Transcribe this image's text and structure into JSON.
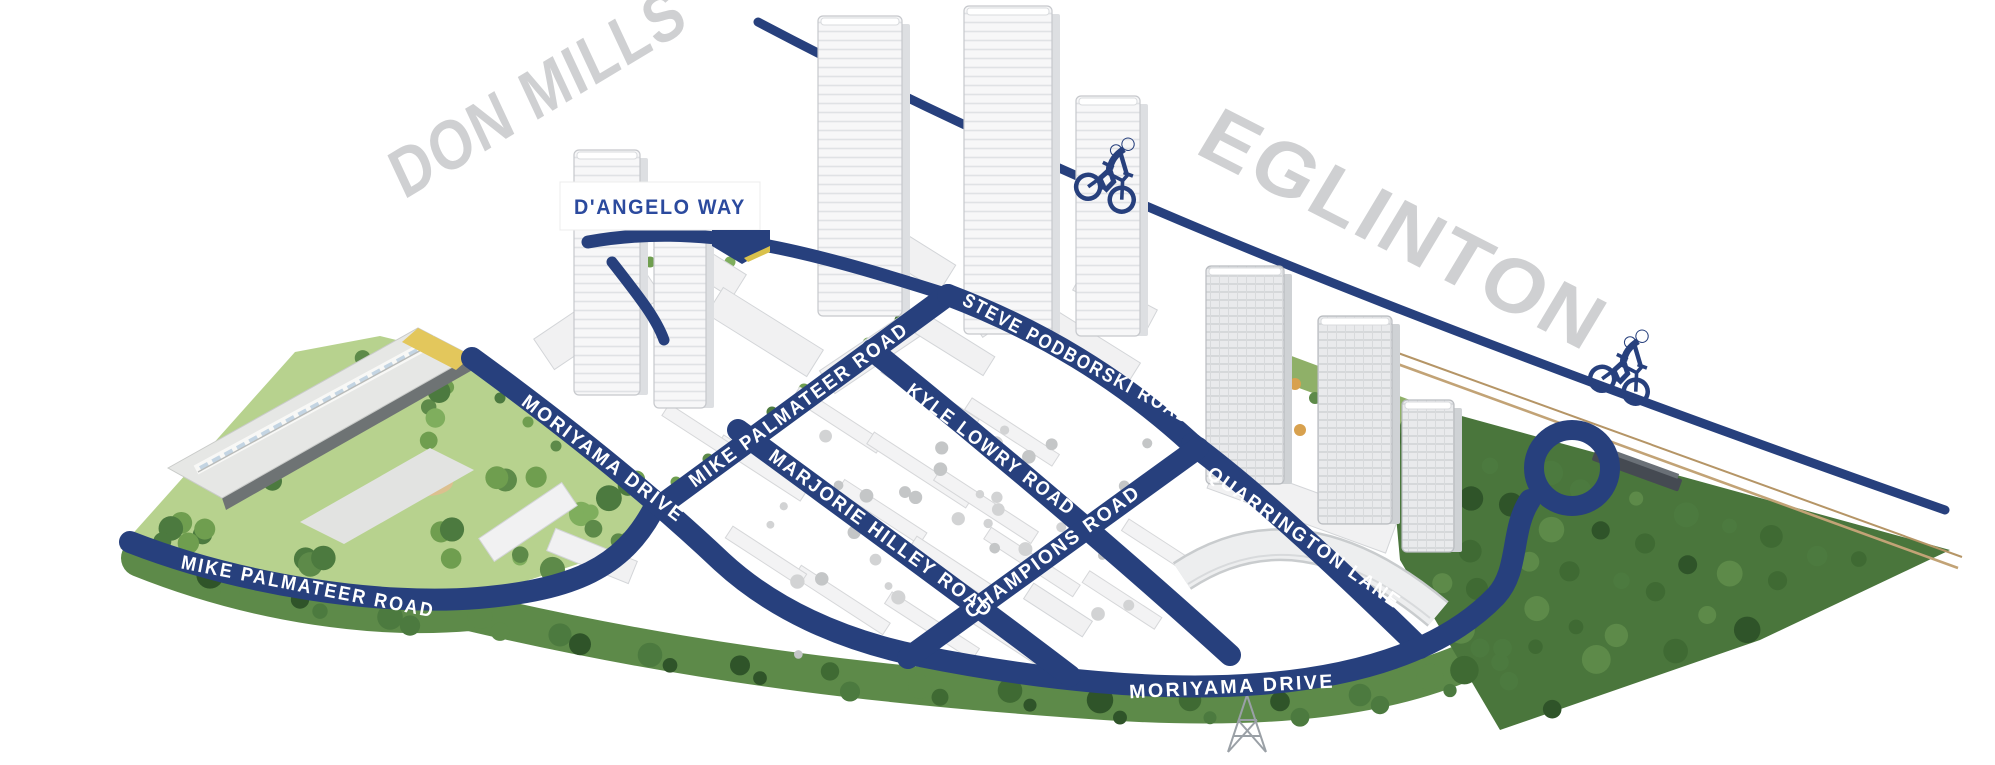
{
  "map": {
    "ghost": {
      "don_mills": "DON MILLS",
      "eglinton": "EGLINTON"
    },
    "sign": {
      "dangelo_way": "D'ANGELO WAY"
    },
    "roads": {
      "steve_podborski": "STEVE PODBORSKI ROAD",
      "mike_palmateer": "MIKE PALMATEER ROAD",
      "kyle_lowry": "KYLE LOWRY ROAD",
      "marjorie_hilley": "MARJORIE HILLEY ROAD",
      "moriyama": "MORIYAMA DRIVE",
      "champions": "CHAMPIONS ROAD",
      "quarrington": "QUARRINGTON LANE"
    },
    "icons": {
      "cyclist": "cyclist-icon",
      "cyclist_count": 2
    },
    "colors": {
      "road": "#27407D",
      "ghost": "#CFD0D2",
      "sign_blue": "#2B4A9E",
      "label": "#FFFFFF",
      "park": "#B7D28E",
      "forest": "#4A763C"
    }
  }
}
